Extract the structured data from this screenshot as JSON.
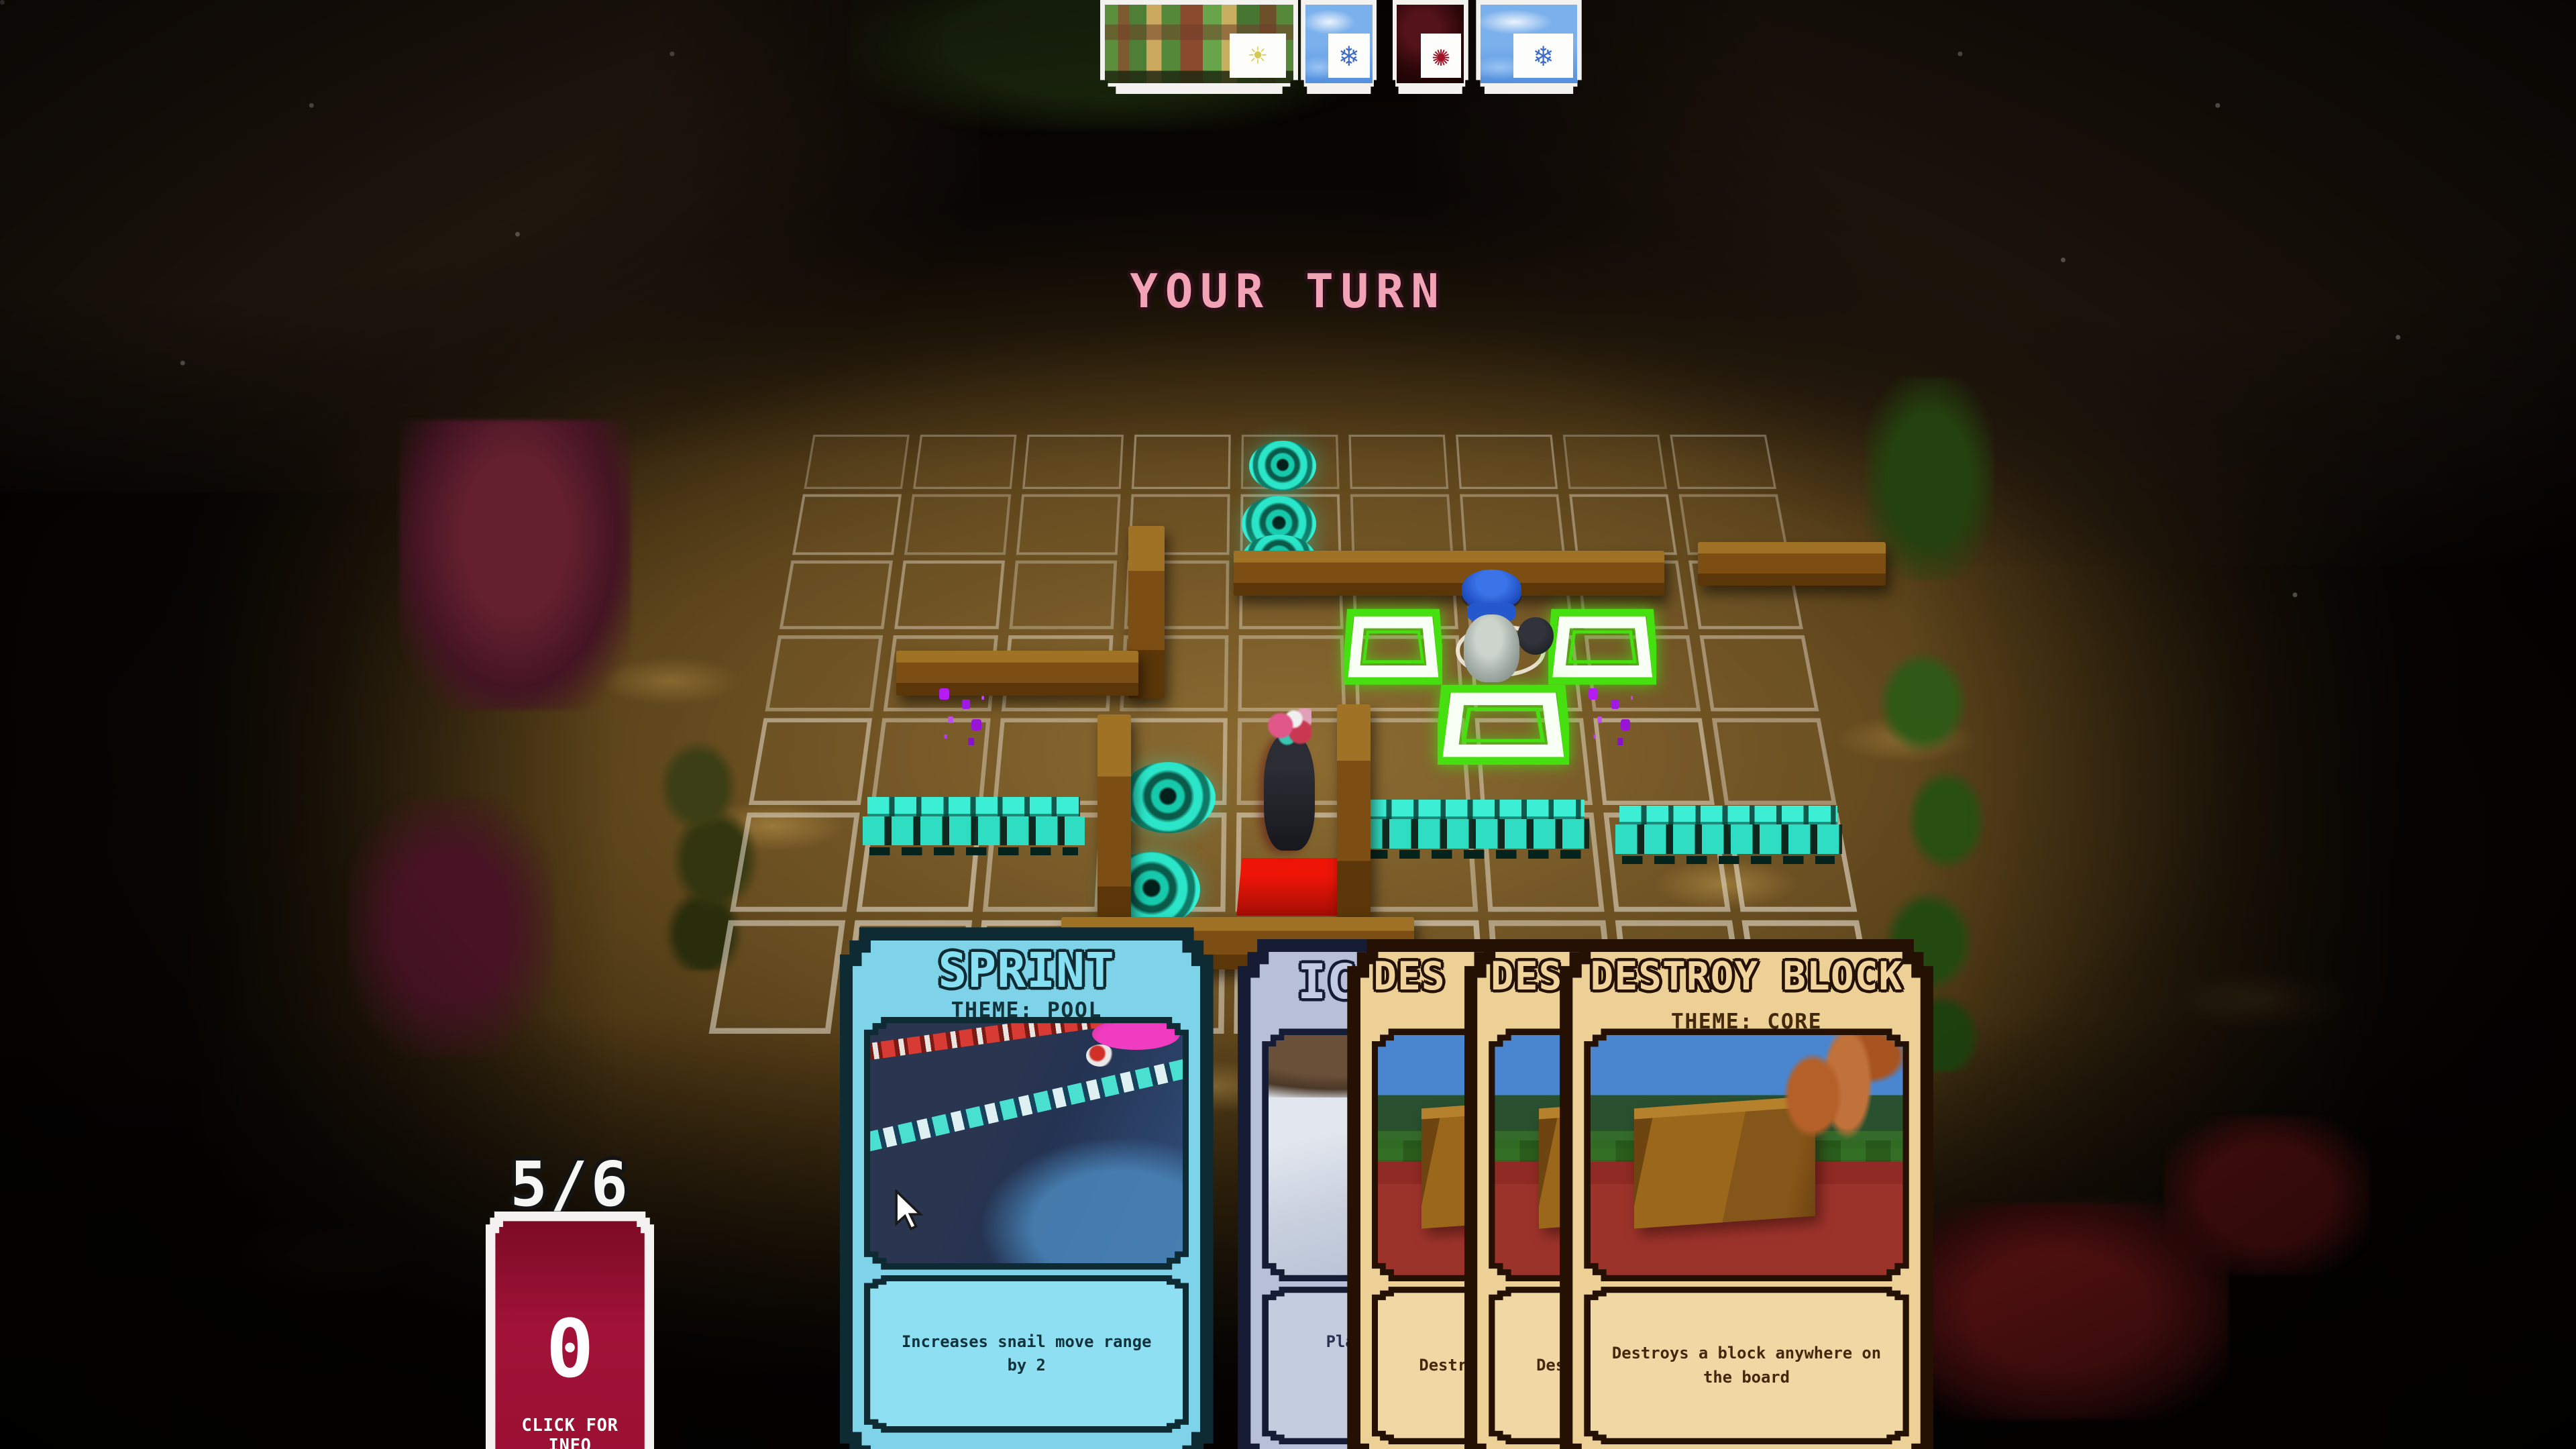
{
  "banner": {
    "text": "YOUR TURN"
  },
  "hud": {
    "hand_count": "5/6",
    "info_card": {
      "value": "0",
      "caption": "CLICK FOR INFO"
    }
  },
  "icons": {
    "sun-icon": "☀",
    "snowflake-icon": "❄",
    "rune-icon": "✺"
  },
  "top_cards": [
    {
      "id": "terrain",
      "style": "terrain",
      "icon": "sun-icon",
      "x": 42.7,
      "w": 7.7
    },
    {
      "id": "ice-a",
      "style": "ice",
      "icon": "snowflake-icon",
      "x": 50.5,
      "w": 2.95
    },
    {
      "id": "ember",
      "style": "ember",
      "icon": "rune-icon",
      "x": 54.05,
      "w": 2.95
    },
    {
      "id": "ice-b",
      "style": "ice",
      "icon": "snowflake-icon",
      "x": 57.3,
      "w": 4.1
    }
  ],
  "hand": [
    {
      "id": "sprint",
      "style": "pool",
      "art": "pool",
      "x": 32.6,
      "top": 64.0,
      "z": 350,
      "title": "SPRINT",
      "theme": "THEME: POOL",
      "desc_lines": [
        {
          "t": "Increases snail move range"
        },
        {
          "t": "by 2"
        }
      ]
    },
    {
      "id": "ice-wall",
      "style": "ice",
      "art": "ice",
      "x": 48.05,
      "top": 64.8,
      "z": 310,
      "title": "IC",
      "title_pad": 16,
      "desc_lines": [
        {
          "t": "Place",
          "pad": 14,
          "mt": 8
        },
        {
          "t": "Will",
          "pad": 30,
          "mt": 22
        }
      ]
    },
    {
      "id": "destroy-1",
      "style": "core",
      "art": "core",
      "x": 52.3,
      "top": 64.8,
      "z": 320,
      "title": "DES",
      "title_pad": 7,
      "desc_lines": [
        {
          "t": "Destro",
          "pad": 8
        }
      ]
    },
    {
      "id": "destroy-2",
      "style": "core",
      "art": "core",
      "x": 56.85,
      "top": 64.8,
      "z": 330,
      "title": "DES",
      "title_pad": 7,
      "desc_lines": [
        {
          "t": "Destro",
          "pad": 8
        }
      ]
    },
    {
      "id": "destroy-block",
      "style": "core",
      "art": "core",
      "x": 60.55,
      "top": 64.8,
      "z": 340,
      "title": "DESTROY BLOCK",
      "theme": "THEME: CORE",
      "desc_lines": [
        {
          "t": "Destroys a block anywhere on"
        },
        {
          "t": "the board"
        }
      ]
    }
  ],
  "board": {
    "grid": {
      "cols": 9,
      "row_fracs": [
        0,
        0.098,
        0.207,
        0.33,
        0.466,
        0.621,
        0.798,
        1
      ],
      "tl": [
        492,
        263
      ],
      "tr": [
        1078,
        263
      ],
      "bl": [
        428,
        632
      ],
      "br": [
        1148,
        632
      ]
    },
    "entities": [
      {
        "type": "portal",
        "x": 48.5,
        "y": 30.4,
        "w": 2.6,
        "h": 3.5
      },
      {
        "type": "portal",
        "x": 48.2,
        "y": 34.2,
        "w": 2.9,
        "h": 3.9
      },
      {
        "type": "portal",
        "x": 48.2,
        "y": 36.9,
        "w": 2.9,
        "h": 3.4
      },
      {
        "type": "portal",
        "x": 43.5,
        "y": 52.6,
        "w": 3.7,
        "h": 4.9
      },
      {
        "type": "portal",
        "x": 42.8,
        "y": 58.8,
        "w": 3.8,
        "h": 5.2
      },
      {
        "type": "wall",
        "x": 47.9,
        "y": 38.0,
        "w": 16.7,
        "h": 3.1
      },
      {
        "type": "wall",
        "x": 65.9,
        "y": 37.4,
        "w": 7.3,
        "h": 3.0
      },
      {
        "type": "wall",
        "x": 43.8,
        "y": 36.3,
        "w": 1.4,
        "h": 11.9
      },
      {
        "type": "wall",
        "x": 34.8,
        "y": 44.9,
        "w": 9.4,
        "h": 3.1
      },
      {
        "type": "wall",
        "x": 42.6,
        "y": 49.3,
        "w": 1.3,
        "h": 16.5
      },
      {
        "type": "wall",
        "x": 51.9,
        "y": 48.6,
        "w": 1.3,
        "h": 15.0
      },
      {
        "type": "wall",
        "x": 41.2,
        "y": 63.3,
        "w": 13.7,
        "h": 3.6
      },
      {
        "type": "red-tile",
        "x": 48.0,
        "y": 59.2,
        "w": 4.2,
        "h": 4.0
      },
      {
        "type": "ring",
        "x": 56.5,
        "y": 43.1,
        "w": 3.5,
        "h": 3.6
      },
      {
        "type": "green-tile",
        "x": 52.2,
        "y": 42.0,
        "w": 3.8,
        "h": 5.3
      },
      {
        "type": "green-tile",
        "x": 60.1,
        "y": 42.0,
        "w": 4.2,
        "h": 5.3
      },
      {
        "type": "green-tile",
        "x": 55.8,
        "y": 47.2,
        "w": 5.1,
        "h": 5.6
      },
      {
        "type": "fence",
        "x": 33.5,
        "y": 55.0,
        "w": 8.6,
        "h": 4.4
      },
      {
        "type": "fence",
        "x": 52.8,
        "y": 55.2,
        "w": 8.9,
        "h": 4.4
      },
      {
        "type": "fence",
        "x": 62.7,
        "y": 55.6,
        "w": 8.8,
        "h": 4.4
      },
      {
        "type": "sparkles",
        "x": 36.2,
        "y": 47.2,
        "w": 2.6,
        "h": 3.2
      },
      {
        "type": "sparkles",
        "x": 61.4,
        "y": 47.2,
        "w": 2.6,
        "h": 3.2
      },
      {
        "type": "snail-blue",
        "x": 56.2,
        "y": 39.3,
        "w": 3.4,
        "h": 7.8,
        "zb": 25
      },
      {
        "type": "blob",
        "x": 58.9,
        "y": 42.6,
        "w": 1.4,
        "h": 2.6,
        "zb": 25
      },
      {
        "type": "snail-dark",
        "x": 48.8,
        "y": 48.9,
        "w": 2.5,
        "h": 9.8,
        "zb": 25
      }
    ]
  },
  "colors": {
    "turn_text": "#f2a4b6",
    "pool_bg": "#7fd3e9",
    "core_bg": "#ecd096",
    "ice_bg": "#b7c0d6",
    "info_card": "#9c1031",
    "portal": "#2ee8cc",
    "highlight": "#52e818",
    "fence": "#38ecd0",
    "wall": "#7c4e13",
    "red_tile": "#e01408"
  }
}
